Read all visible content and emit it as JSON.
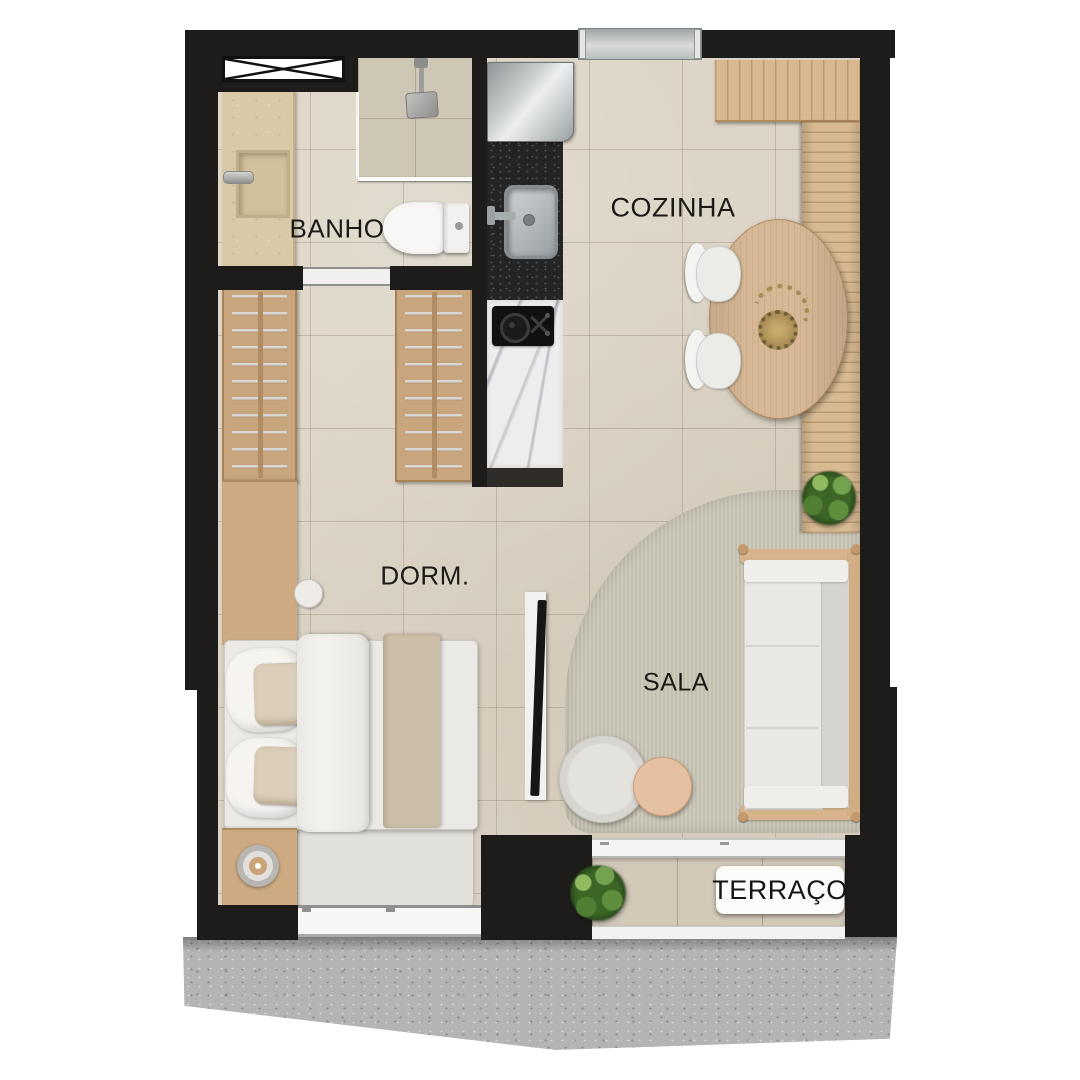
{
  "rooms": {
    "banho": {
      "label": "BANHO"
    },
    "cozinha": {
      "label": "COZINHA"
    },
    "dorm": {
      "label": "DORM."
    },
    "sala": {
      "label": "SALA"
    },
    "terraco": {
      "label": "TERRAÇO"
    }
  },
  "colors": {
    "wall": "#1d1c1b",
    "floor_tile": "#dbd3c4",
    "wood": "#cdaa82",
    "deck": "#d8ba92",
    "concrete": "#b4b5b2",
    "rug": "#c9c5b6",
    "marble": "#eceded",
    "granite": "#242424",
    "plant": "#3c6526",
    "label_text": "#1c1a17"
  },
  "fixtures": [
    "duct-shaft",
    "shower",
    "vanity",
    "toilet",
    "wardrobes",
    "bed",
    "nightstand-lamp",
    "tv-panel",
    "sofa",
    "coffee-tables",
    "dining-table",
    "dining-chairs",
    "fridge",
    "kitchen-sink",
    "cooktop",
    "deck",
    "plants",
    "sliding-door",
    "windows",
    "terrace-plate",
    "concrete-apron"
  ]
}
